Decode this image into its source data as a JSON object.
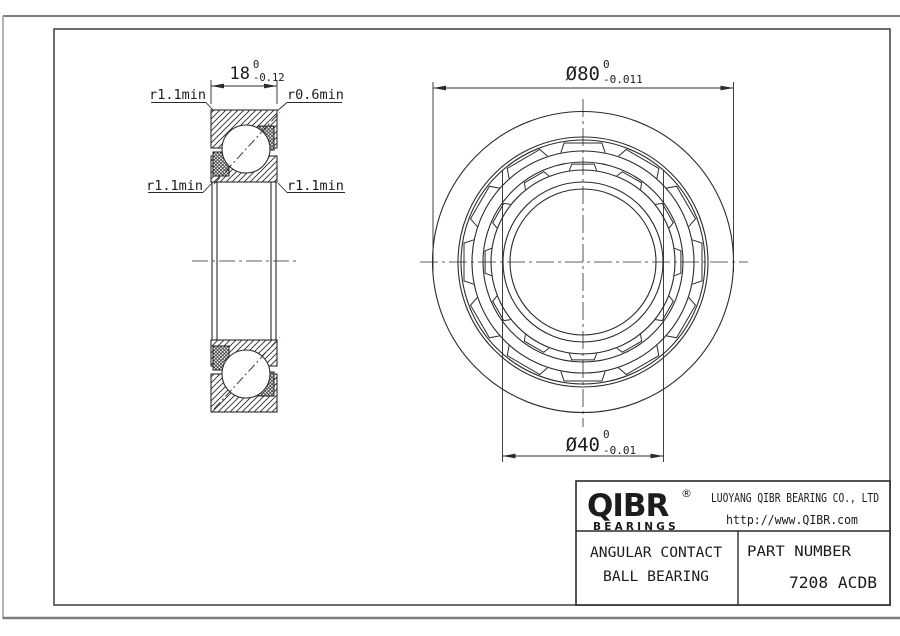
{
  "drawing": {
    "dimensions": {
      "width": {
        "value": "18",
        "tol_upper": "0",
        "tol_lower": "-0.12"
      },
      "outer_diameter": {
        "value": "Ø80",
        "tol_upper": "0",
        "tol_lower": "-0.011"
      },
      "bore_diameter": {
        "value": "Ø40",
        "tol_upper": "0",
        "tol_lower": "-0.01"
      },
      "radius_top_left": "r1.1min",
      "radius_top_right": "r0.6min",
      "radius_mid_left": "r1.1min",
      "radius_mid_right": "r1.1min"
    }
  },
  "title_block": {
    "logo_text": "QIBR",
    "logo_registered": "®",
    "logo_subtext": "BEARINGS",
    "company_name": "LUOYANG QIBR BEARING CO., LTD",
    "company_url": "http://www.QIBR.com",
    "product_type_line1": "ANGULAR CONTACT",
    "product_type_line2": "BALL BEARING",
    "part_number_label": "PART NUMBER",
    "part_number_value": "7208 ACDB"
  }
}
